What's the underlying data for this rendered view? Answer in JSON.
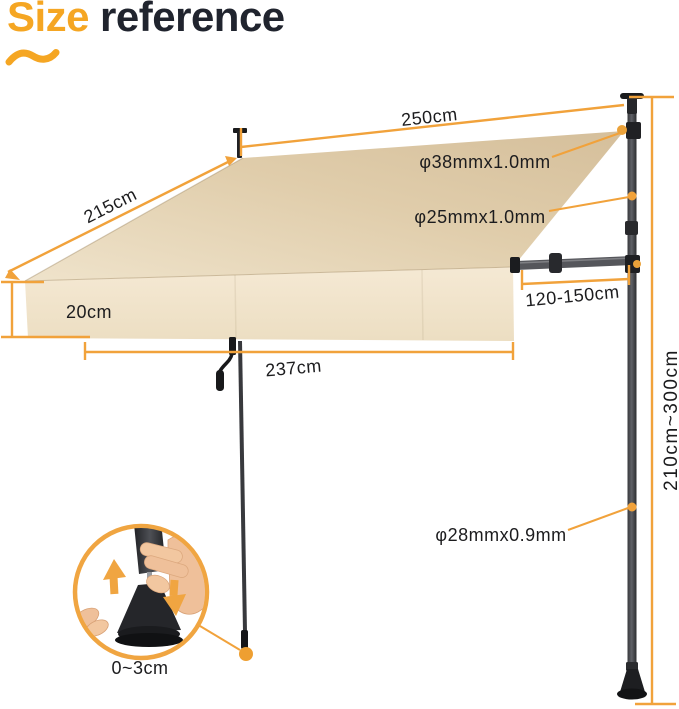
{
  "title": {
    "highlight": "Size",
    "rest": "reference"
  },
  "dimensions": {
    "top_width": "250cm",
    "slant_depth": "215cm",
    "upper_pole_diameter": "φ38mmx1.0mm",
    "mid_pole_diameter": "φ25mmx1.0mm",
    "crossbar_extension": "120-150cm",
    "valance_height": "20cm",
    "front_width": "237cm",
    "pole_height_range": "210cm~300cm",
    "lower_pole_diameter": "φ28mmx0.9mm",
    "foot_adjust_range": "0~3cm"
  },
  "colors": {
    "accent_orange": "#F1A23B",
    "title_accent": "#F5A623",
    "title_dark": "#20242E",
    "fabric_top": "#DCC8A6",
    "fabric_valance": "#F2E5CD",
    "frame_gray": "#3F4044",
    "label_text": "#1C1C1E"
  }
}
